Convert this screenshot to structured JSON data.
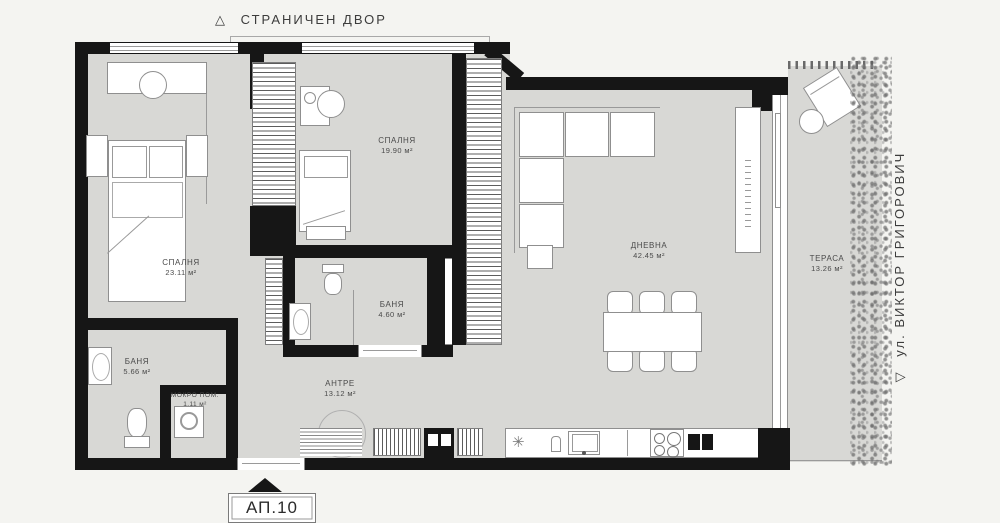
{
  "labels": {
    "side_yard": {
      "icon": "△",
      "text": "СТРАНИЧЕН ДВОР"
    },
    "street": {
      "icon": "▽",
      "text": "ул. ВИКТОР ГРИГОРОВИЧ"
    },
    "unit": {
      "text": "АП.10"
    }
  },
  "rooms": [
    {
      "id": "bedroom-1",
      "name": "СПАЛНЯ",
      "area": "23.11 м²"
    },
    {
      "id": "bedroom-2",
      "name": "СПАЛНЯ",
      "area": "19.90 м²"
    },
    {
      "id": "bathroom-2",
      "name": "БАНЯ",
      "area": "4.60 м²"
    },
    {
      "id": "bathroom-1",
      "name": "БАНЯ",
      "area": "5.66 м²"
    },
    {
      "id": "laundry",
      "name": "МОКРО ПОМ.",
      "area": "1.11 м²"
    },
    {
      "id": "hallway",
      "name": "АНТРЕ",
      "area": "13.12 м²"
    },
    {
      "id": "living",
      "name": "ДНЕВНА",
      "area": "42.45 м²"
    },
    {
      "id": "terrace",
      "name": "ТЕРАСА",
      "area": "13.26 м²"
    }
  ],
  "colors": {
    "wall": "#161616",
    "floor": "#d8d8d5",
    "background": "#f4f4f1"
  }
}
